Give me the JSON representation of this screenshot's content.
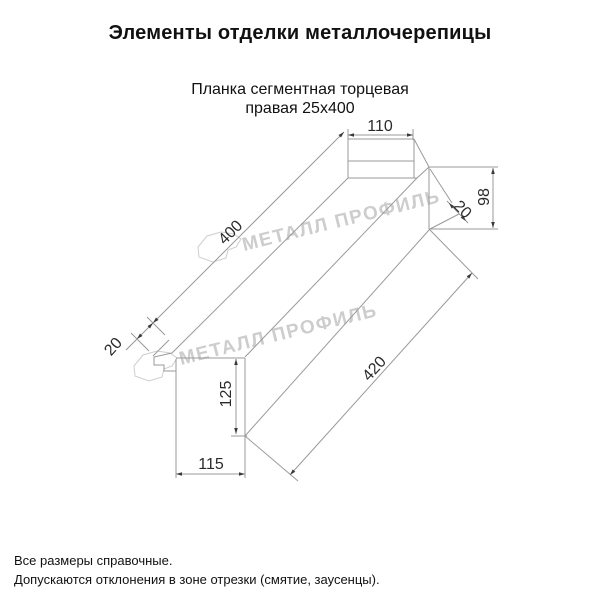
{
  "title": "Элементы отделки металлочерепицы",
  "subtitle": {
    "line1": "Планка сегментная торцевая",
    "line2": "правая 25х400"
  },
  "watermark": {
    "text": "МЕТАЛЛ ПРОФИЛЬ",
    "color": "#cbcbcb"
  },
  "drawing": {
    "dimensions": {
      "top_width": "110",
      "right_height": "98",
      "right_fold": "20",
      "top_length": "400",
      "left_fold": "20",
      "bottom_length": "420",
      "left_height": "125",
      "bottom_width": "115"
    }
  },
  "footer": {
    "line1": "Все размеры справочные.",
    "line2": "Допускаются отклонения в зоне отрезки (смятие, заусенцы)."
  },
  "colors": {
    "background": "#ffffff",
    "line": "#9a9a9a",
    "text": "#111111",
    "dimension_text": "#2b2b2b",
    "watermark": "#cbcbcb"
  }
}
